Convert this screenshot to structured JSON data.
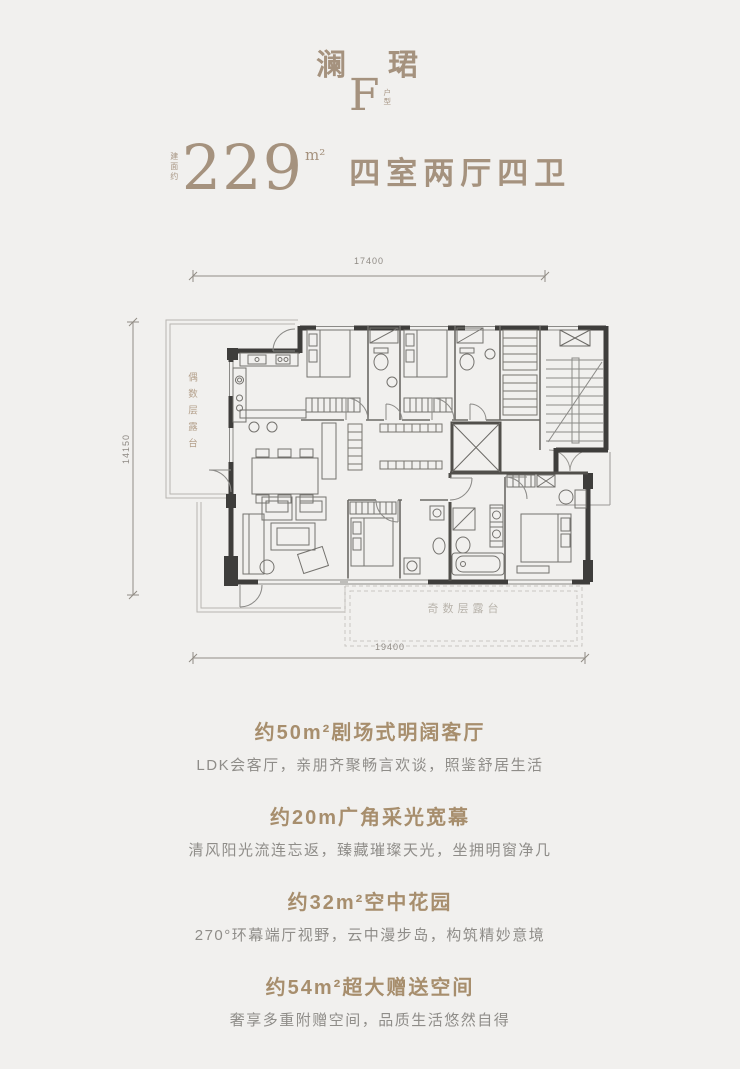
{
  "header": {
    "project_name": "澜　珺",
    "unit_letter": "F",
    "unit_type_chars": {
      "c1": "户",
      "c2": "型"
    },
    "area_prefix": "建面约",
    "area_value": "229",
    "area_unit": "m²",
    "layout_summary": "四室两厅四卫"
  },
  "floorplan": {
    "dim_top": "17400",
    "dim_left": "14150",
    "dim_bottom": "19400",
    "terrace_even_label": "偶数层露台",
    "terrace_odd_label": "奇数层露台"
  },
  "colors": {
    "background": "#f1f0ee",
    "brand_text": "#a5927e",
    "section_heading": "#a78e6d",
    "section_body": "#8f8d89",
    "wall": "#3e3d3b",
    "thin_line": "#8b8a87",
    "terrace_line": "#b8b5b0"
  },
  "sections": [
    {
      "heading": "约50m²剧场式明阔客厅",
      "body": "LDK会客厅，亲朋齐聚畅言欢谈，照鉴舒居生活"
    },
    {
      "heading": "约20m广角采光宽幕",
      "body": "清风阳光流连忘返，臻藏璀璨天光，坐拥明窗净几"
    },
    {
      "heading": "约32m²空中花园",
      "body": "270°环幕端厅视野，云中漫步岛，构筑精妙意境"
    },
    {
      "heading": "约54m²超大赠送空间",
      "body": "奢享多重附赠空间，品质生活悠然自得"
    }
  ]
}
